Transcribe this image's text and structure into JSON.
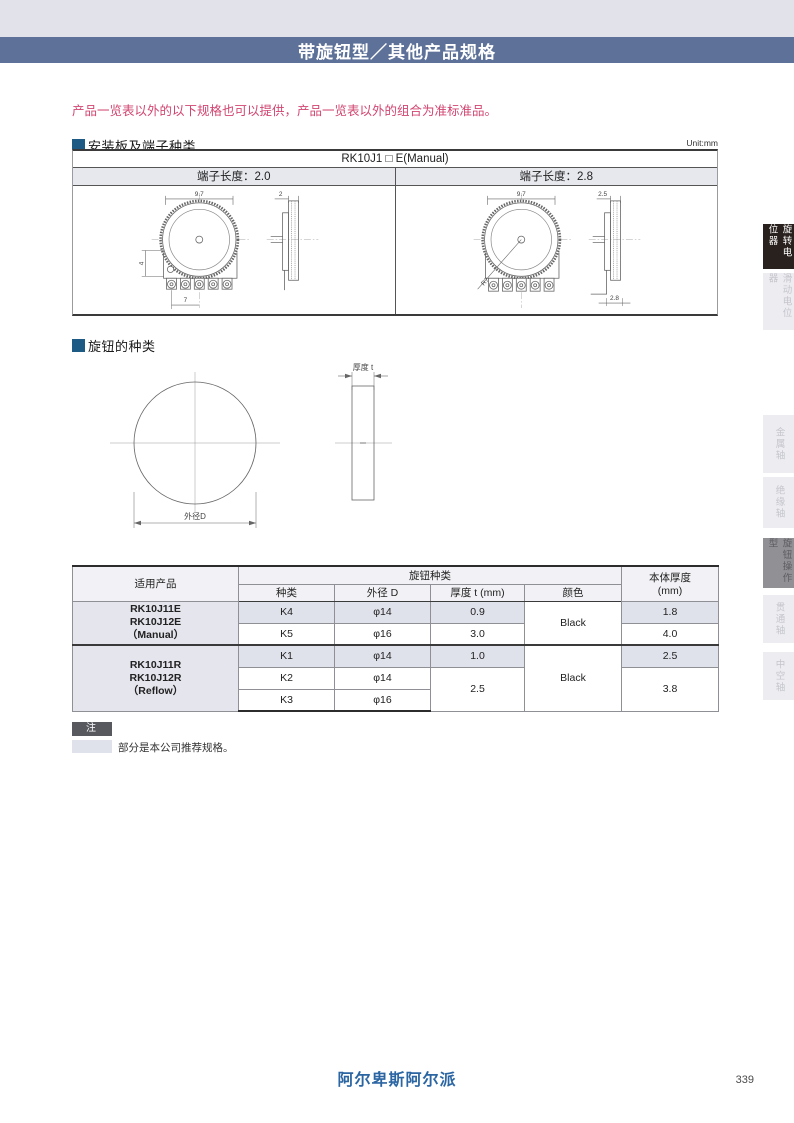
{
  "header": {
    "title": "带旋钮型／其他产品规格"
  },
  "notice": "产品一览表以外的以下规格也可以提供，产品一览表以外的组合为准标准品。",
  "section_mounting": {
    "title": "安装板及端子种类",
    "unit": "Unit:mm",
    "model_header": "RK10J1 □ E(Manual)",
    "variant_left": "端子长度：2.0",
    "variant_right": "端子长度：2.8"
  },
  "drawings": {
    "left": {
      "top_width": "9.7",
      "side_gap": "2",
      "left_height": "4",
      "bottom_width": "7"
    },
    "right": {
      "top_width": "9.7",
      "side_gap": "2.5",
      "bottom_gap": "2.8",
      "radius": "R7"
    },
    "knob": {
      "thickness": "厚度 t",
      "diameter": "外径D"
    }
  },
  "section_knob": {
    "title": "旋钮的种类"
  },
  "spec_table": {
    "headers": {
      "product": "适用产品",
      "knob_type": "旋钮种类",
      "kind": "种类",
      "outer_dia": "外径 D",
      "thickness": "厚度 t (mm)",
      "color": "颜色",
      "body_thickness_line1": "本体厚度",
      "body_thickness_line2": "(mm)"
    },
    "groups": [
      {
        "product_lines": [
          "RK10J11E",
          "RK10J12E",
          "（Manual）"
        ],
        "color": "Black",
        "rows": [
          {
            "kind": "K4",
            "dia": "φ14",
            "t": "0.9",
            "body": "1.8"
          },
          {
            "kind": "K5",
            "dia": "φ16",
            "t": "3.0",
            "body": "4.0"
          }
        ]
      },
      {
        "product_lines": [
          "RK10J11R",
          "RK10J12R",
          "（Reflow）"
        ],
        "color": "Black",
        "rows": [
          {
            "kind": "K1",
            "dia": "φ14",
            "t": "1.0",
            "body": "2.5"
          },
          {
            "kind": "K2",
            "dia": "φ14",
            "t": "2.5",
            "body": "3.8"
          },
          {
            "kind": "K3",
            "dia": "φ16"
          }
        ]
      }
    ]
  },
  "note": {
    "badge": "注",
    "text": "部分是本公司推荐规格。"
  },
  "sidebar": {
    "items": [
      {
        "label": "旋转电位器"
      },
      {
        "label": "滑动电位器"
      },
      {
        "label": "金属轴"
      },
      {
        "label": "绝缘轴"
      },
      {
        "label": "旋钮操作型"
      },
      {
        "label": "贯通轴"
      },
      {
        "label": "中空轴"
      }
    ]
  },
  "footer": {
    "brand": "阿尔卑斯阿尔派",
    "page_number": "339"
  },
  "colors": {
    "header_bar": "#5e7299",
    "accent_square": "#1d5b84",
    "notice_red": "#d24571",
    "recommended_highlight": "#e0e2eb"
  }
}
